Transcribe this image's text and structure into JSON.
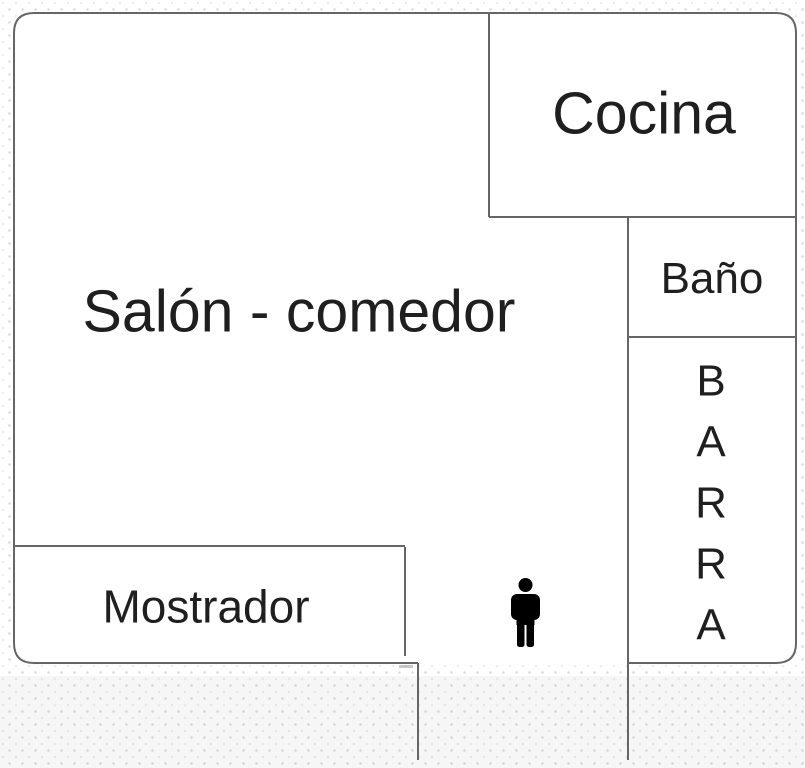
{
  "rooms": {
    "salon": {
      "name": "Salón - comedor"
    },
    "cocina": {
      "name": "Cocina"
    },
    "bano": {
      "name": "Baño"
    },
    "barra": {
      "name": "BARRA",
      "display": "B\nA\nR\nR\nA"
    },
    "mostrador": {
      "name": "Mostrador"
    }
  },
  "figures": {
    "person": {
      "icon": "person-icon"
    }
  },
  "colors": {
    "wall": "#666666",
    "room_fill": "#ffffff",
    "text": "#1f1f1f",
    "background_dot": "#dcdcdc",
    "bottom_band": "#f2f2f2",
    "person": "#000000"
  }
}
